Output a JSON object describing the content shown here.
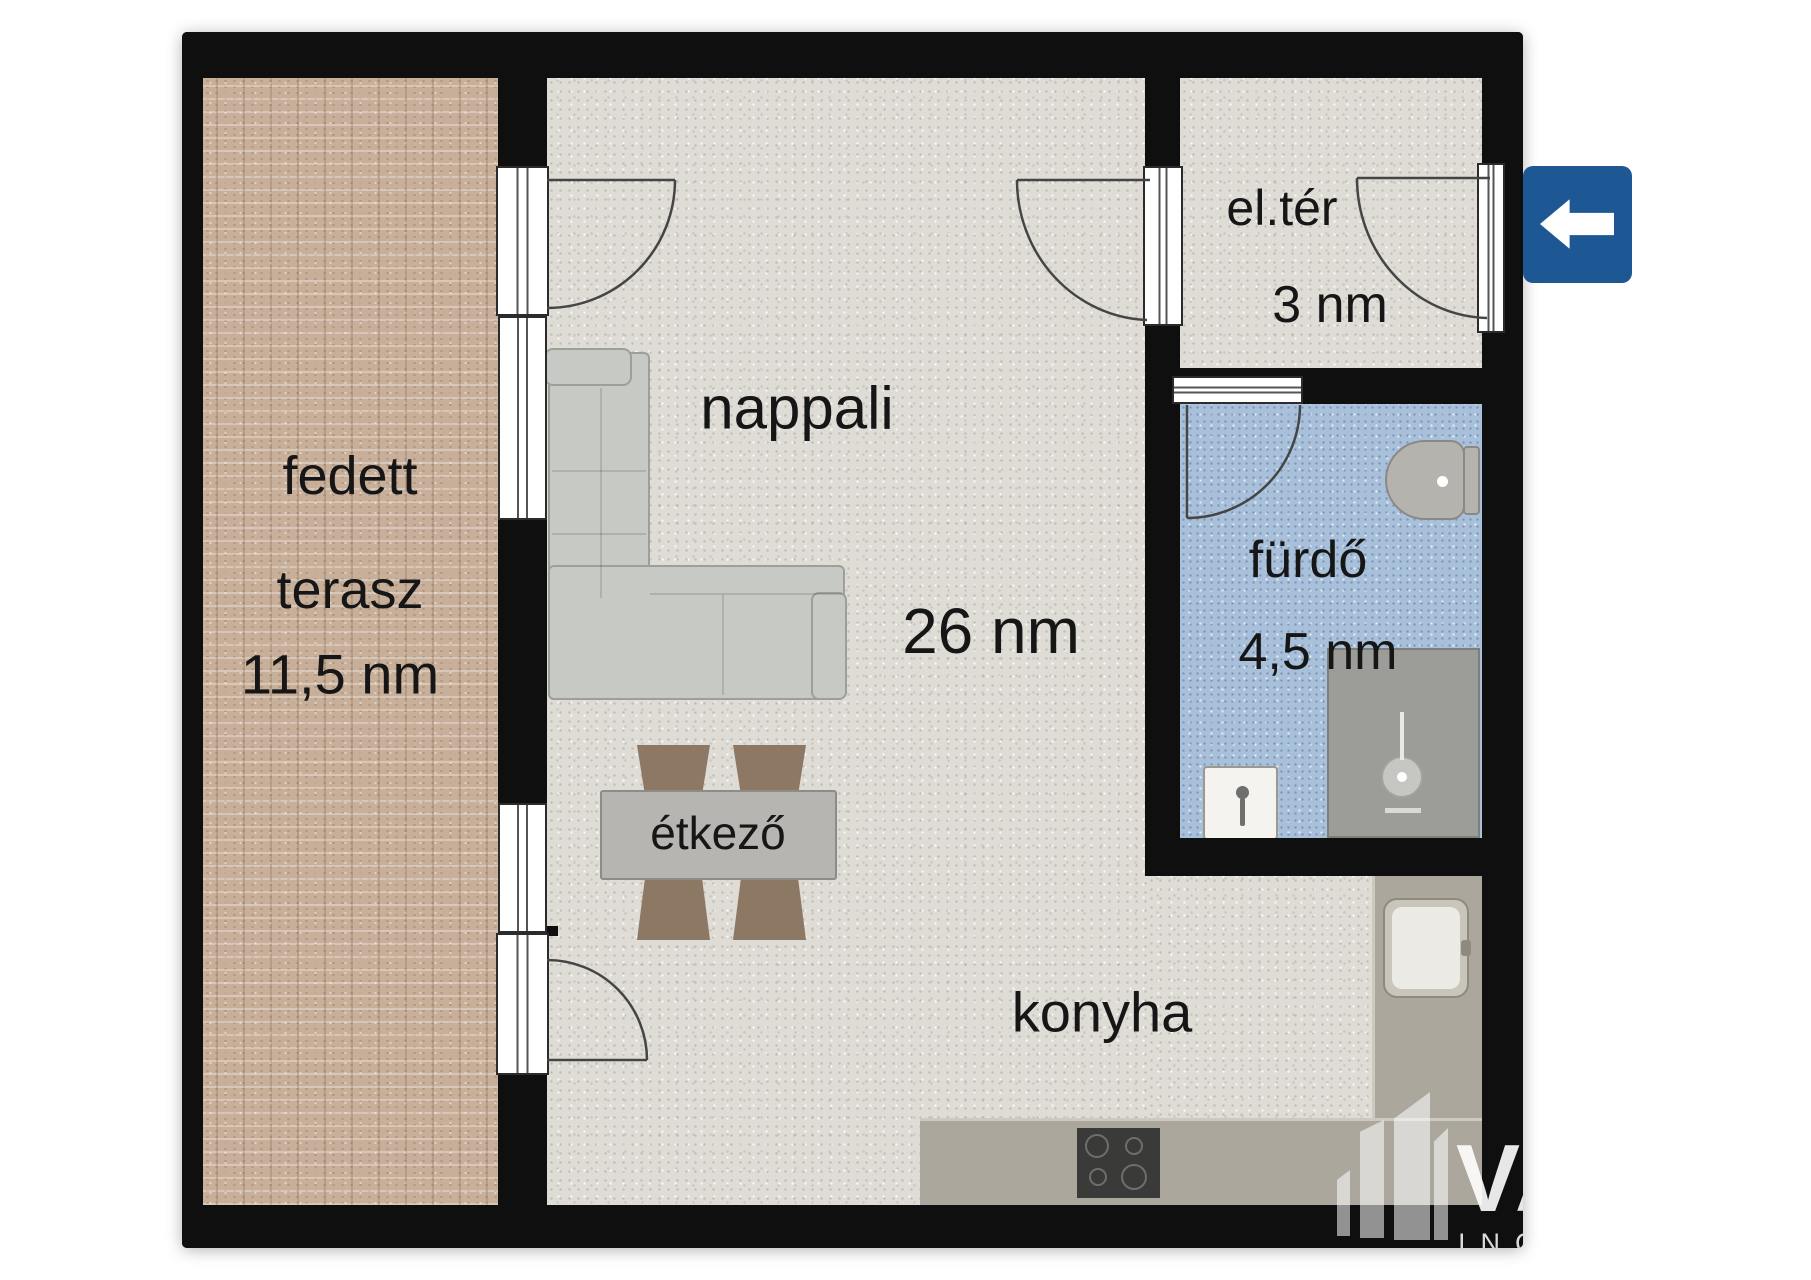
{
  "floorplan": {
    "rooms": {
      "terrace": {
        "name_line1": "fedett",
        "name_line2": "terasz",
        "area": "11,5 nm"
      },
      "living": {
        "name": "nappali",
        "area": "26 nm"
      },
      "dining": {
        "name": "étkező"
      },
      "kitchen": {
        "name": "konyha"
      },
      "entry": {
        "name": "el.tér",
        "area": "3 nm"
      },
      "bath": {
        "name": "fürdő",
        "area": "4,5 nm"
      }
    },
    "entrance_marker": {
      "icon": "arrow-left-icon",
      "color": "#1d5894"
    },
    "watermark": {
      "line1": "VA",
      "line2": "ING",
      "icon": "buildings-icon"
    },
    "palette": {
      "wall": "#0f0f0f",
      "floor_main": "#dedcd5",
      "floor_terrace": "#c7af99",
      "floor_bath": "#a9c0da",
      "counter": "#aba79d",
      "sofa": "#c7cac4",
      "chair": "#8d7863",
      "arrow_blue": "#1d5894"
    }
  }
}
